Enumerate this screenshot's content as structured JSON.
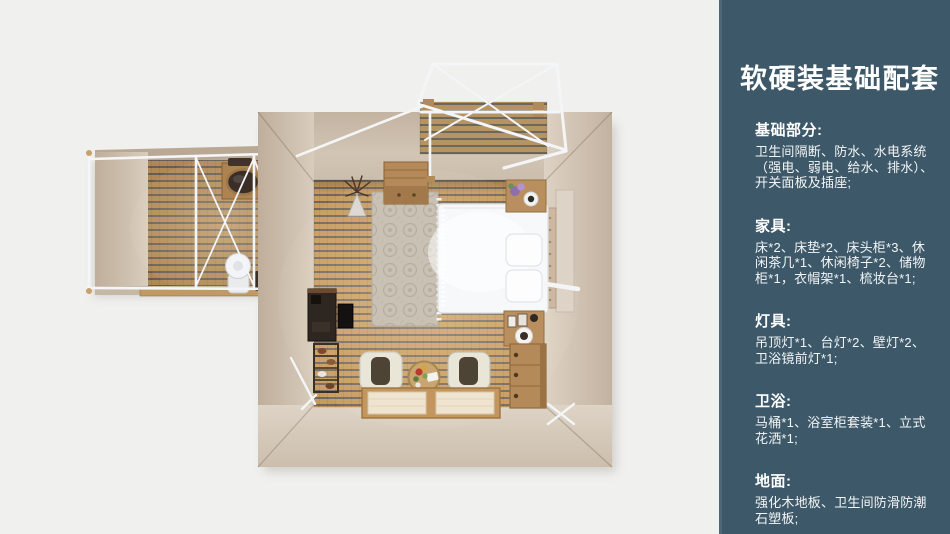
{
  "page": {
    "background": "#f0f0ef"
  },
  "sidebar": {
    "background": "#3d5868",
    "accent_strip": "#4e6675",
    "text_color": "#ffffff",
    "title": "软硬装基础配套",
    "sections": [
      {
        "heading": "基础部分:",
        "body": "卫生间隔断、防水、水电系统（强电、弱电、给水、排水）、开关面板及插座;"
      },
      {
        "heading": "家具:",
        "body": "床*2、床垫*2、床头柜*3、休闲茶几*1、休闲椅子*2、储物柜*1，衣帽架*1、梳妆台*1;"
      },
      {
        "heading": "灯具:",
        "body": "吊顶灯*1、台灯*2、壁灯*2、卫浴镜前灯*1;"
      },
      {
        "heading": "卫浴:",
        "body": "马桶*1、浴室柜套装*1、立式花洒*1;"
      },
      {
        "heading": "地面:",
        "body": "强化木地板、卫生间防滑防潮石塑板;"
      }
    ]
  },
  "floorplan": {
    "view": "top-down-3d-render",
    "colors": {
      "wall": "#cec0af",
      "wood_floor": "#c79a5e",
      "deck_wood": "#b49463",
      "frame_white": "#f4f5f7",
      "rug": "#c8c1b4",
      "bed": "#f7f8fa"
    },
    "scene_items": [
      "bedroom",
      "bathroom",
      "deck-pergola",
      "bed",
      "pillows",
      "headboard",
      "nightstand-top",
      "nightstand-bottom",
      "rug",
      "wardrobe-box",
      "branch-decor",
      "desk",
      "tv-panel",
      "shoe-rack",
      "armchair-left",
      "armchair-right",
      "coffee-table",
      "floor-mats",
      "drawer-chest",
      "mirror-panel",
      "sink-left",
      "sink-right",
      "vanity-counter",
      "toilet",
      "laundry-baskets"
    ]
  }
}
